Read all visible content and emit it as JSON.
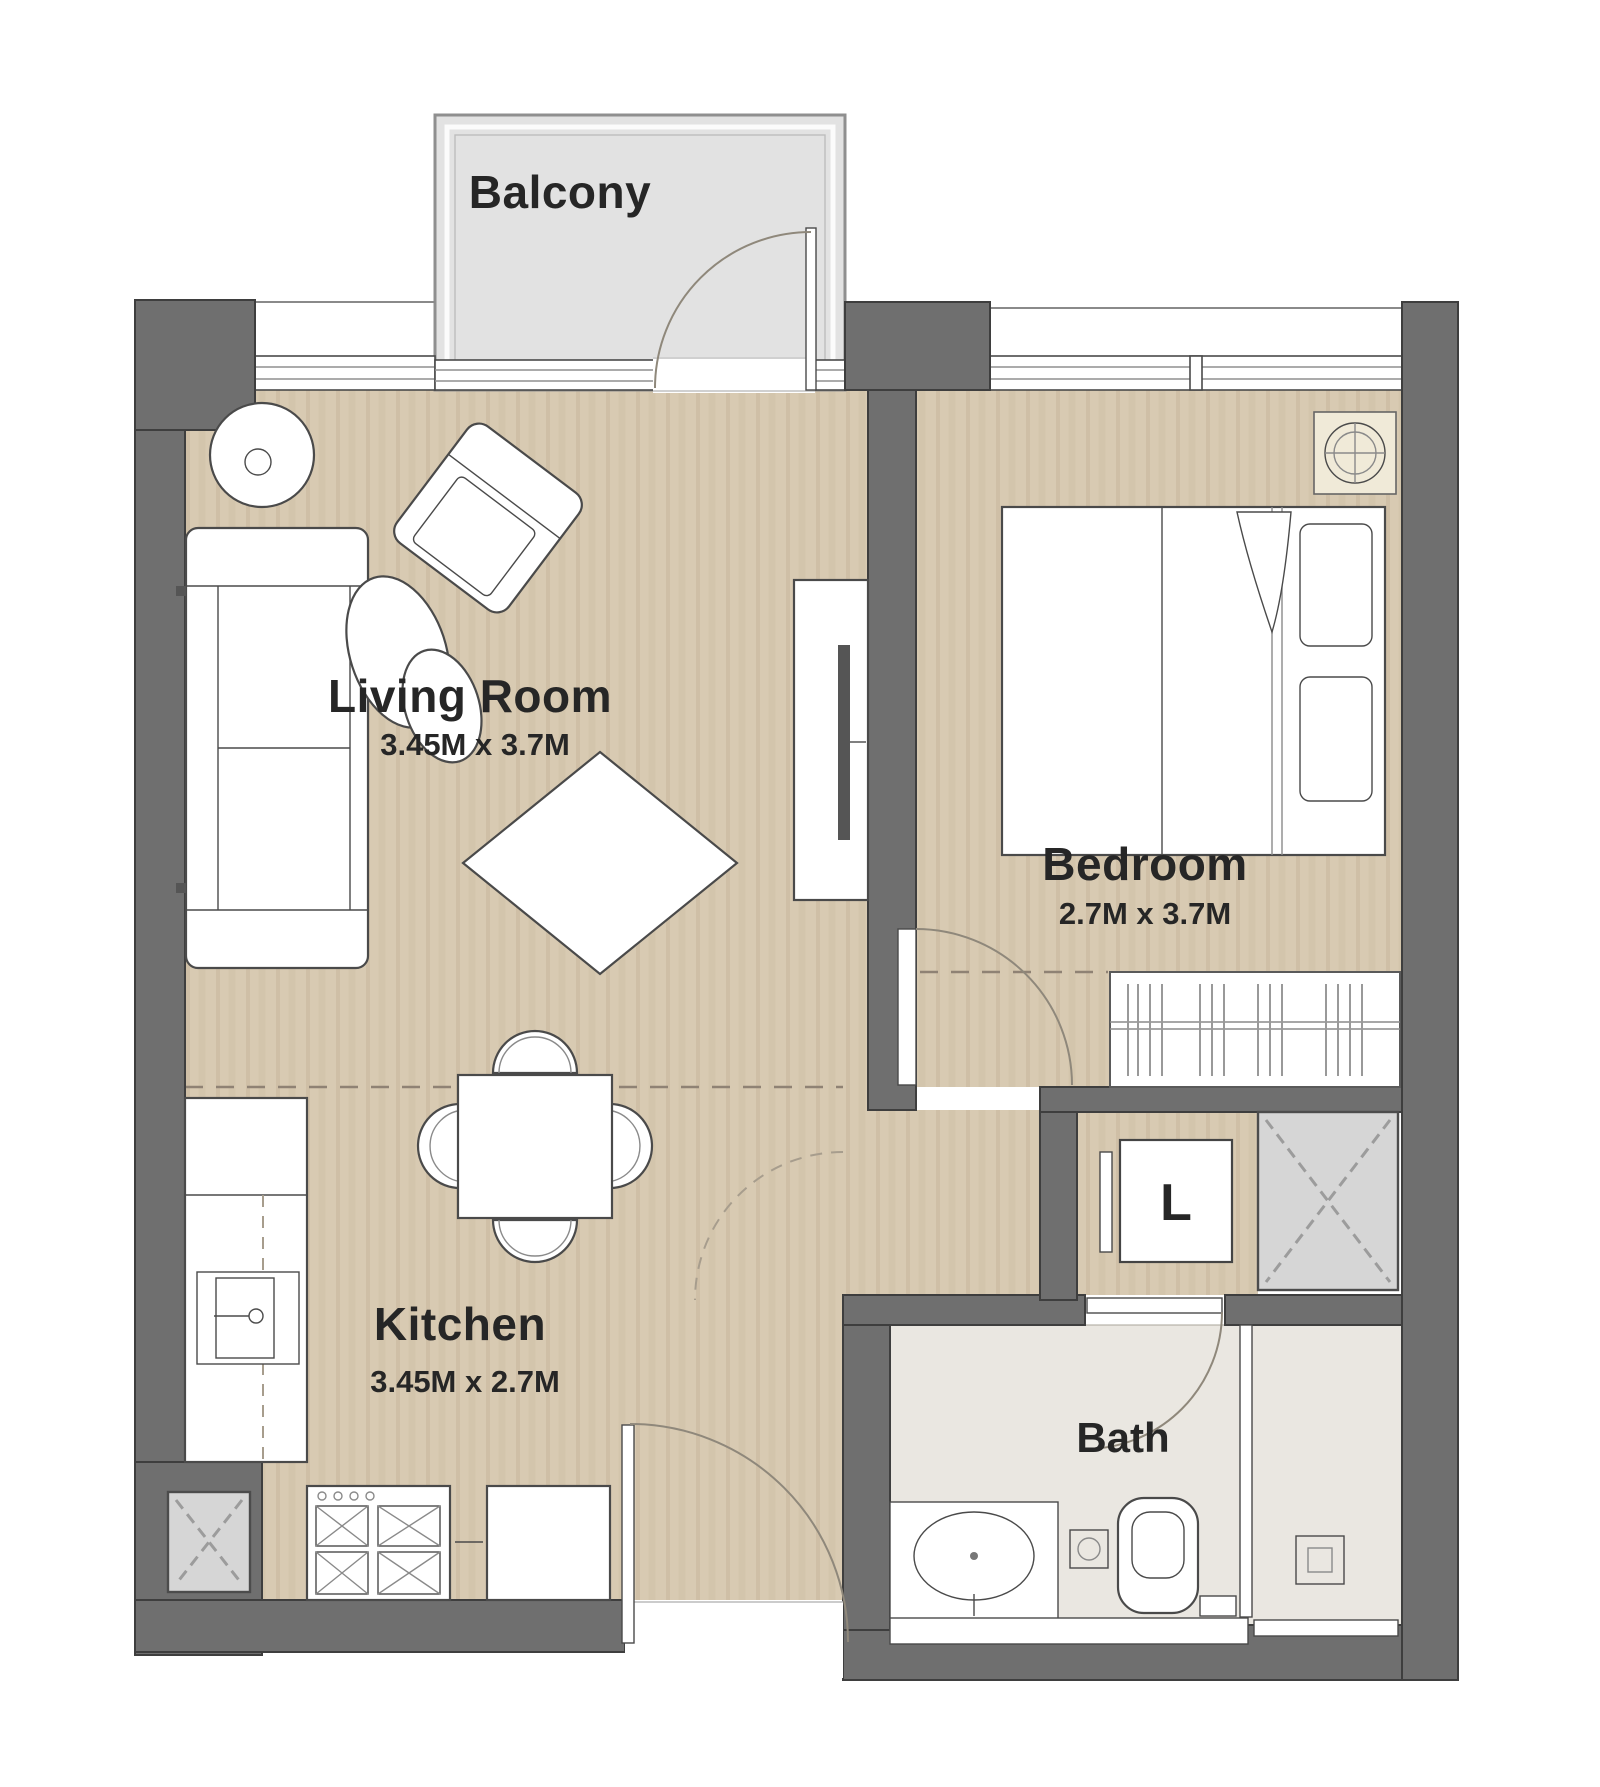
{
  "plan": {
    "type": "apartment-floor-plan",
    "unit": "1 Bedroom Apartment",
    "rooms": {
      "balcony": {
        "label": "Balcony"
      },
      "living_room": {
        "label": "Living Room",
        "dims": "3.45M x 3.7M"
      },
      "bedroom": {
        "label": "Bedroom",
        "dims": "2.7M x 3.7M"
      },
      "kitchen": {
        "label": "Kitchen",
        "dims": "3.45M x 2.7M"
      },
      "bath": {
        "label": "Bath"
      },
      "laundry": {
        "label": "L"
      }
    }
  },
  "colors": {
    "wall": "#6f6f6f",
    "wall_stroke": "#3e3e3e",
    "floor": "#d8cab2",
    "bath_floor": "#eae7e1",
    "balcony": "#e2e2e2",
    "shaft": "#d6d6d6",
    "ac_panel": "#f0ead8",
    "line": "#4a4a4a",
    "text": "#262626"
  }
}
